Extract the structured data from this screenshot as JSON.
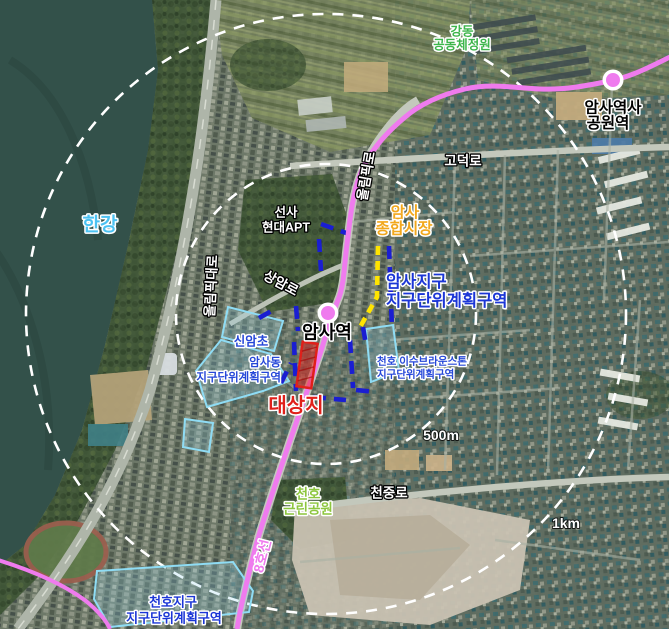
{
  "map": {
    "colors": {
      "metro_line": "#ef7bee",
      "boundary_blue": "#1a1ed2",
      "boundary_yellow": "#ffe400",
      "district_cyan": "#8fdcf4",
      "target_red": "#e0201a",
      "circle_white": "#ffffff",
      "river": "#33514a",
      "text_black": "#000000",
      "text_white": "#ffffff",
      "hangang_blue": "#4cc2f2",
      "garden_green": "#3db54b",
      "park_green": "#8dc63f",
      "market_gold": "#f2a81d",
      "district_text_blue": "#1b36d6",
      "district_text_blue_small": "#2547d8"
    },
    "labels": {
      "gangdong_garden": {
        "line1": "강동",
        "line2": "공동체정원"
      },
      "amsa_history_station": {
        "line1": "암사역사",
        "line2": "공원역"
      },
      "godeok_ro": {
        "text": "고덕로"
      },
      "hangang": {
        "text": "한강"
      },
      "olympic_ro": {
        "text": "올림픽로"
      },
      "olympic_daero": {
        "text": "올림픽대로"
      },
      "seonsa_apt": {
        "line1": "선사",
        "line2": "현대APT"
      },
      "sangam_ro": {
        "text": "상암로"
      },
      "amsa_market": {
        "line1": "암사",
        "line2": "종합시장"
      },
      "amsa_district": {
        "line1": "암사지구",
        "line2": "지구단위계획구역"
      },
      "amsa_station": {
        "text": "암사역"
      },
      "sinam_elementary": {
        "text": "신암초"
      },
      "amsadong_district": {
        "line1": "암사동",
        "line2": "지구단위계획구역"
      },
      "cheonho_isu": {
        "line1": "천호 이수브라운스톤",
        "line2": "지구단위계획구역"
      },
      "target_site": {
        "text": "대상지"
      },
      "radius_500m": {
        "text": "500m"
      },
      "cheonjung_ro": {
        "text": "천중로"
      },
      "cheonho_park": {
        "line1": "천호",
        "line2": "근린공원"
      },
      "line8": {
        "text": "8호선"
      },
      "radius_1km": {
        "text": "1km"
      },
      "cheonho_district": {
        "line1": "천호지구",
        "line2": "지구단위계획구역"
      }
    }
  }
}
